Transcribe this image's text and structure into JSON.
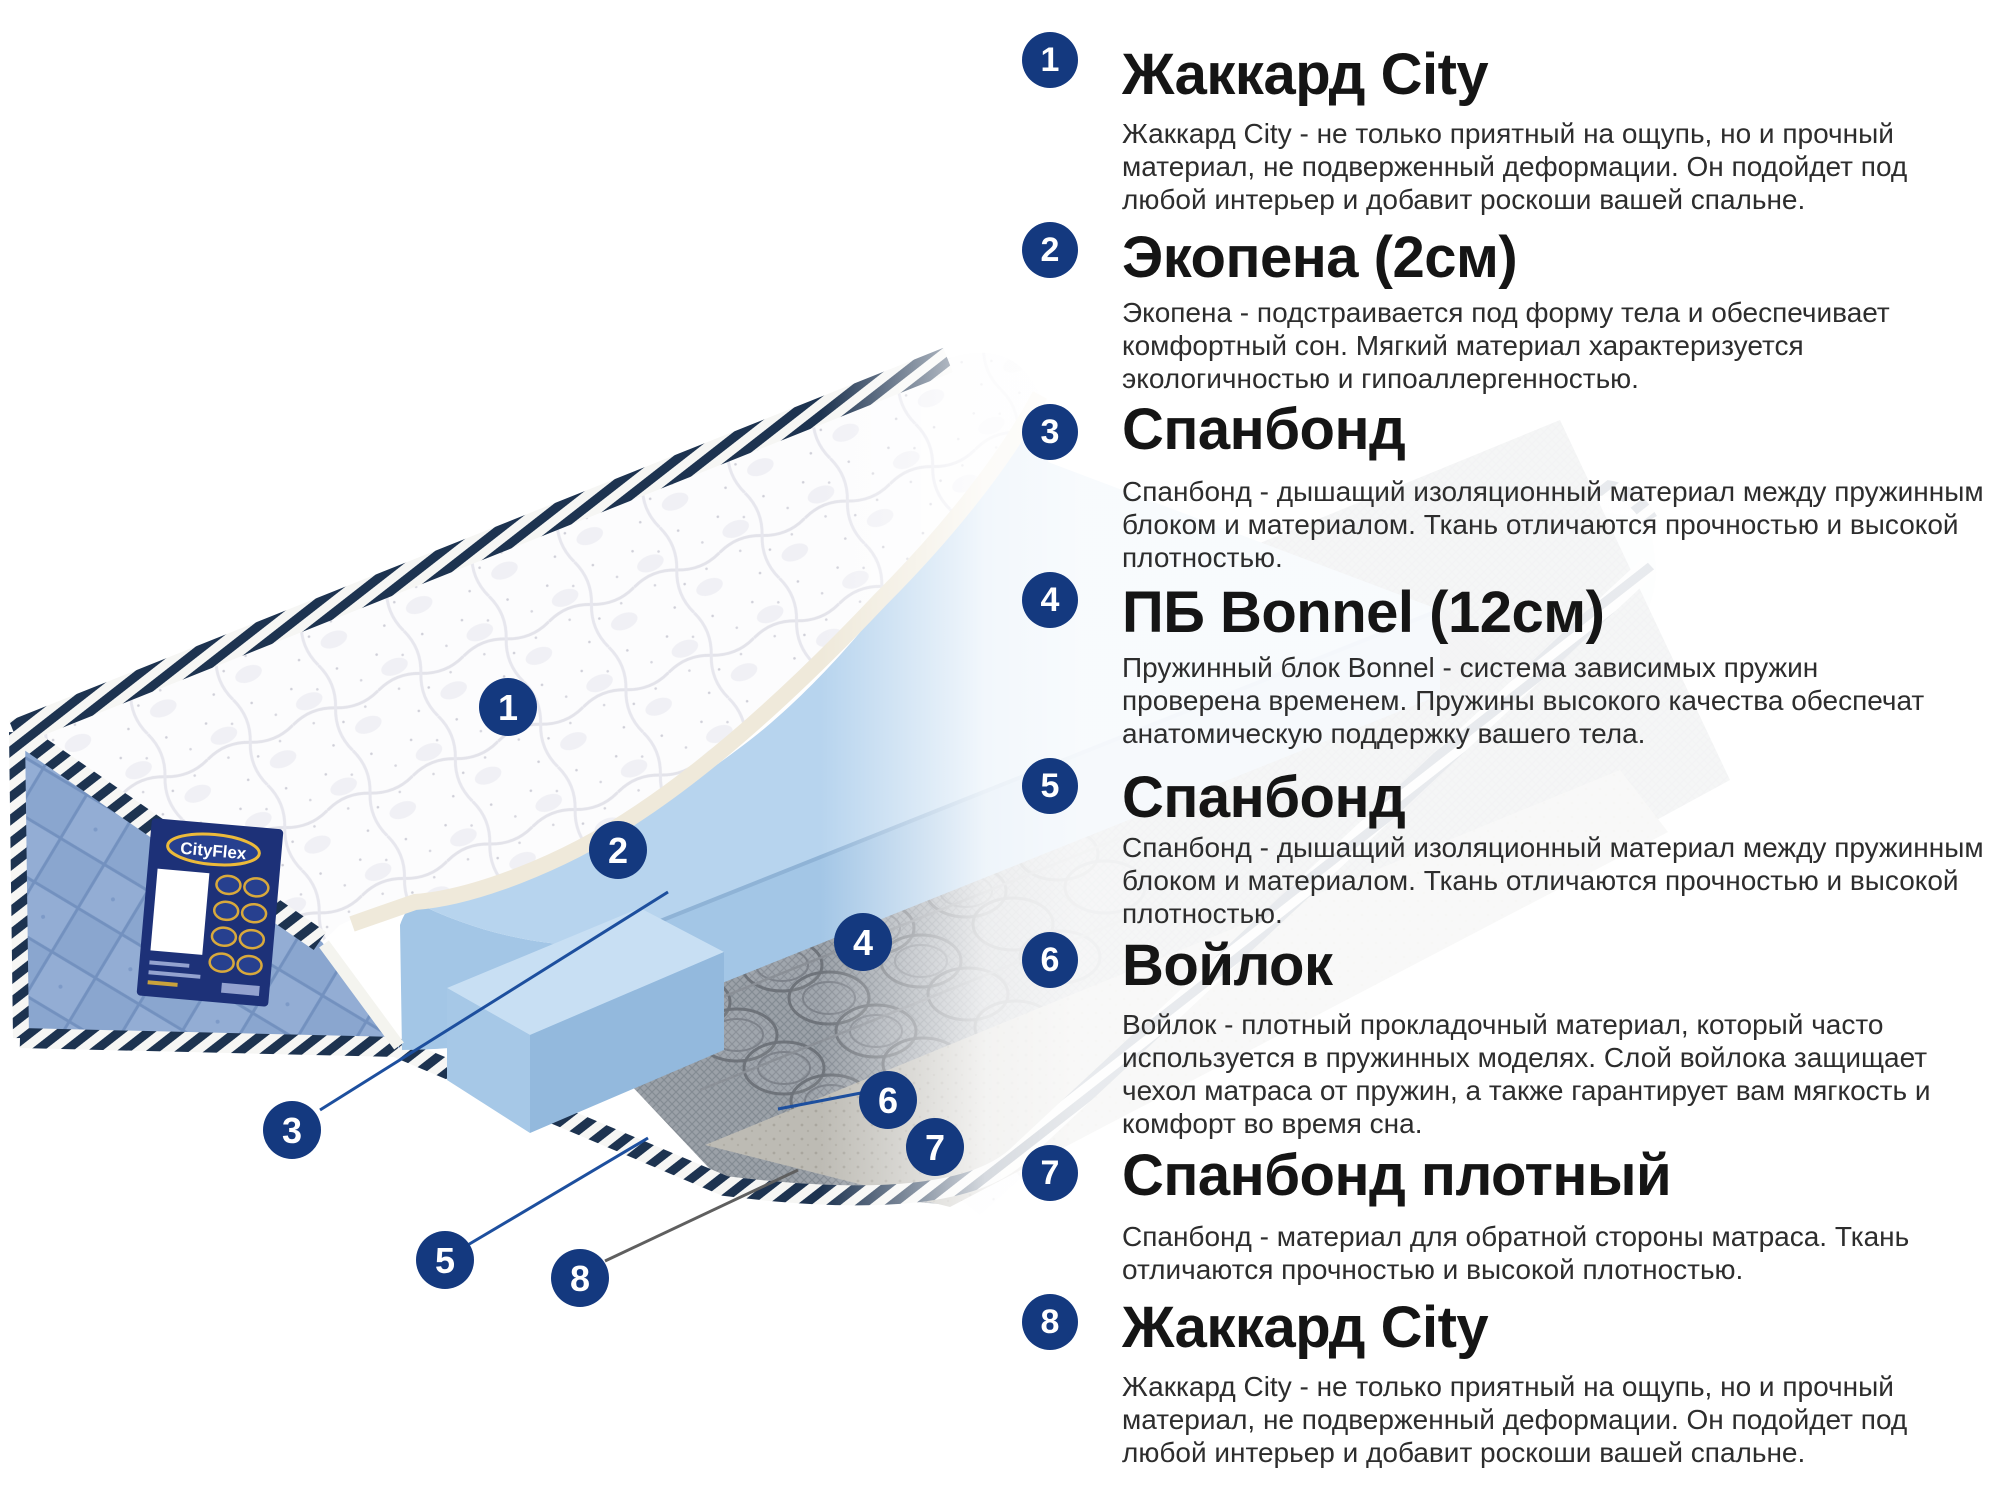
{
  "colors": {
    "accent_navy": "#14397f",
    "leader_blue": "#1d4f9e",
    "leader_gray": "#5f5f5f",
    "foam_blue": "#b7d4ee",
    "stripe_navy": "#1d3350",
    "panel_blue": "#8aa6cf",
    "label_navy": "#1d3178",
    "label_gold": "#ecba3a"
  },
  "label": {
    "brand": "CityFlex"
  },
  "markers": [
    {
      "num": "1"
    },
    {
      "num": "2"
    },
    {
      "num": "3"
    },
    {
      "num": "4"
    },
    {
      "num": "5"
    },
    {
      "num": "6"
    },
    {
      "num": "7"
    },
    {
      "num": "8"
    }
  ],
  "sections": [
    {
      "num": "1",
      "title": "Жаккард City",
      "body": "Жаккард City - не только приятный на ощупь, но и прочный\nматериал, не подверженный деформации. Он подойдет под\nлюбой интерьер и добавит роскоши вашей спальне."
    },
    {
      "num": "2",
      "title": "Экопена (2см)",
      "body": "Экопена - подстраивается под форму тела и обеспечивает\nкомфортный сон. Мягкий материал характеризуется\nэкологичностью и гипоаллергенностью."
    },
    {
      "num": "3",
      "title": "Спанбонд",
      "body": "Спанбонд - дышащий изоляционный материал между пружинным\nблоком и материалом. Ткань отличаются прочностью и высокой\nплотностью."
    },
    {
      "num": "4",
      "title": "ПБ Bonnel (12см)",
      "body": "Пружинный блок Bonnel - система зависимых пружин\nпроверена временем. Пружины высокого качества обеспечат\nанатомическую поддержку вашего тела."
    },
    {
      "num": "5",
      "title": "Спанбонд",
      "body": "Спанбонд - дышащий изоляционный материал между пружинным\nблоком и материалом. Ткань отличаются прочностью и высокой\nплотностью."
    },
    {
      "num": "6",
      "title": "Войлок",
      "body": "Войлок - плотный прокладочный материал, который часто\nиспользуется в пружинных моделях. Слой войлока защищает\nчехол матраса от пружин, а также гарантирует вам мягкость и\nкомфорт во время сна."
    },
    {
      "num": "7",
      "title": "Спанбонд плотный",
      "body": "Спанбонд - материал для обратной стороны матраса. Ткань\nотличаются прочностью и высокой плотностью."
    },
    {
      "num": "8",
      "title": "Жаккард City",
      "body": "Жаккард City - не только приятный на ощупь, но и прочный\nматериал, не подверженный деформации. Он подойдет под\nлюбой интерьер и добавит роскоши вашей спальне."
    }
  ]
}
